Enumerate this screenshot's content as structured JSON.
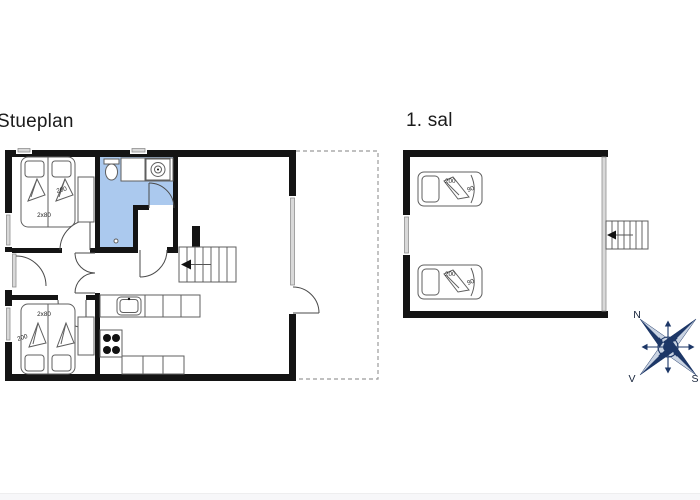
{
  "titles": {
    "ground": "Stueplan",
    "first": "1. sal"
  },
  "ground_floor": {
    "bed_top": {
      "length": "200",
      "width": "2x80"
    },
    "bed_bottom": {
      "length": "200",
      "width": "2x80"
    }
  },
  "first_floor": {
    "bed_top": {
      "length": "200",
      "width": "90"
    },
    "bed_bottom": {
      "length": "200",
      "width": "90"
    }
  },
  "compass": {
    "n": "N",
    "v": "V",
    "s": "S"
  },
  "icons": {
    "compass_rose": "compass-rose",
    "stairs_arrow": "direction-arrow"
  },
  "colors": {
    "wall": "#141414",
    "bathroom": "#abc9ee",
    "window_fill": "#d9d9d9",
    "window_frame": "#8f8f8f",
    "furniture": "#5f5f5f",
    "door": "#4a4a4a",
    "dash": "#9b9b9b",
    "compass": "#1d3767",
    "compass_light": "#c9d3e2",
    "label": "#222222",
    "title": "#1b1b1b",
    "background": "#ffffff"
  }
}
